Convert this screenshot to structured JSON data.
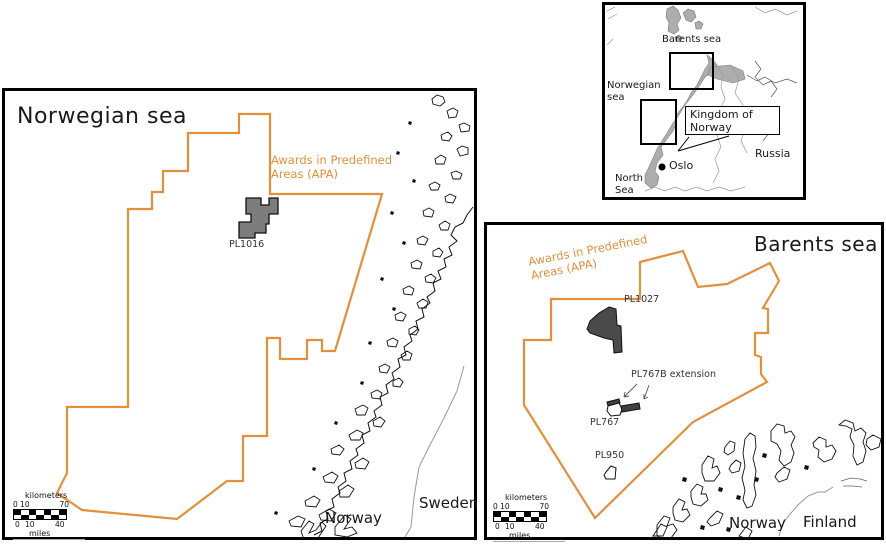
{
  "colors": {
    "apa_orange": "#E2903E",
    "license_medium_gray": "#7d7d7d",
    "license_dark_gray": "#4a4a4a",
    "license_bar_dark": "#3f3f3f",
    "land_gray": "#adadad",
    "border_black": "#000000",
    "country_border_gray": "#999999"
  },
  "scalebar": {
    "top_unit": "kilometers",
    "bottom_unit": "miles",
    "km_left": "0 10",
    "km_right": "70",
    "mi_0": "0",
    "mi_10": "10",
    "mi_40": "40"
  },
  "panels": {
    "norwegian_sea": {
      "title": "Norwegian sea",
      "apa_label": "Awards in Predefined Areas (APA)",
      "license_pl1016": "PL1016",
      "label_norway": "Norway",
      "label_sweden": "Sweden"
    },
    "barents_sea": {
      "title": "Barents sea",
      "apa_label": "Awards in Predefined Areas (APA)",
      "license_pl1027": "PL1027",
      "license_pl767b": "PL767B extension",
      "license_pl767": "PL767",
      "license_pl950": "PL950",
      "label_norway": "Norway",
      "label_finland": "Finland"
    },
    "overview": {
      "label_barents_sea": "Barents sea",
      "label_norwegian_sea": "Norwegian sea",
      "label_kingdom": "Kingdom of Norway",
      "label_russia": "Russia",
      "label_oslo": "Oslo",
      "label_north_sea": "North Sea"
    }
  }
}
